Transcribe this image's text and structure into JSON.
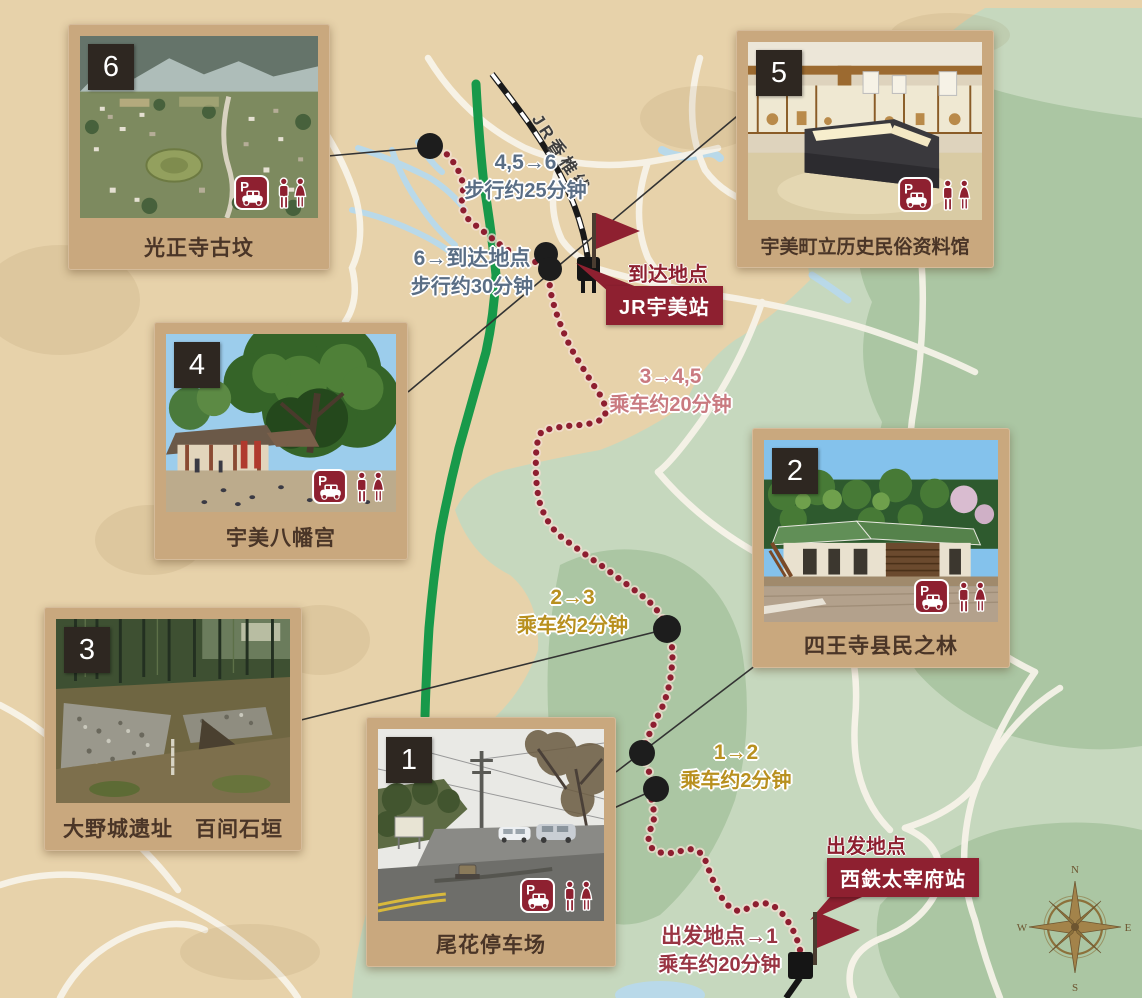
{
  "colors": {
    "paper": "#e7d2aa",
    "road": "#f8f4ea",
    "green-light": "#c6d8be",
    "green-dark": "#abc6a3",
    "water": "#b9d9e9",
    "route-green": "#18994a",
    "route-dot": "#8e1e30",
    "accent-red": "#8e2030",
    "card-frame": "#c9a87e",
    "card-caption": "#4a3527",
    "number-box": "#2e2721",
    "leader": "#333333",
    "compass-gold": "#8c713b"
  },
  "cards": {
    "c1": {
      "number": "1",
      "title": "尾花停车场",
      "parking": true,
      "toilet": true
    },
    "c2": {
      "number": "2",
      "title": "四王寺县民之林",
      "parking": true,
      "toilet": true
    },
    "c3": {
      "number": "3",
      "title": "大野城遗址　百间石垣",
      "parking": false,
      "toilet": false
    },
    "c4": {
      "number": "4",
      "title": "宇美八幡宫",
      "parking": true,
      "toilet": true
    },
    "c5": {
      "number": "5",
      "title": "宇美町立历史民俗资料馆",
      "parking": true,
      "toilet": true
    },
    "c6": {
      "number": "6",
      "title": "光正寺古坟",
      "parking": true,
      "toilet": true
    }
  },
  "route_labels": {
    "walk_45_to_6": {
      "line1": "4,5→6",
      "line2": "步行约25分钟",
      "color": "#5a6e85"
    },
    "walk_6_to_arrival": {
      "line1": "6→到达地点",
      "line2": "步行约30分钟",
      "color": "#5a6e85"
    },
    "bus_3_to_45": {
      "line1": "3→4,5",
      "line2": "乘车约20分钟",
      "color": "#c97a80"
    },
    "bus_2_to_3": {
      "line1": "2→3",
      "line2": "乘车约2分钟",
      "color": "#b8901f"
    },
    "bus_1_to_2": {
      "line1": "1→2",
      "line2": "乘车约2分钟",
      "color": "#b8901f"
    },
    "bus_start_to_1": {
      "line1": "出发地点→1",
      "line2": "乘车约20分钟",
      "color": "#993543"
    }
  },
  "stations": {
    "arrival": {
      "caption": "到达地点",
      "name": "JR宇美站"
    },
    "departure": {
      "caption": "出发地点",
      "name": "西鉄太宰府站"
    }
  },
  "railway": {
    "label": "JR香椎线"
  },
  "compass": {
    "n": "N",
    "e": "E",
    "s": "S",
    "w": "W"
  },
  "icons": {
    "parking_letter": "P"
  }
}
